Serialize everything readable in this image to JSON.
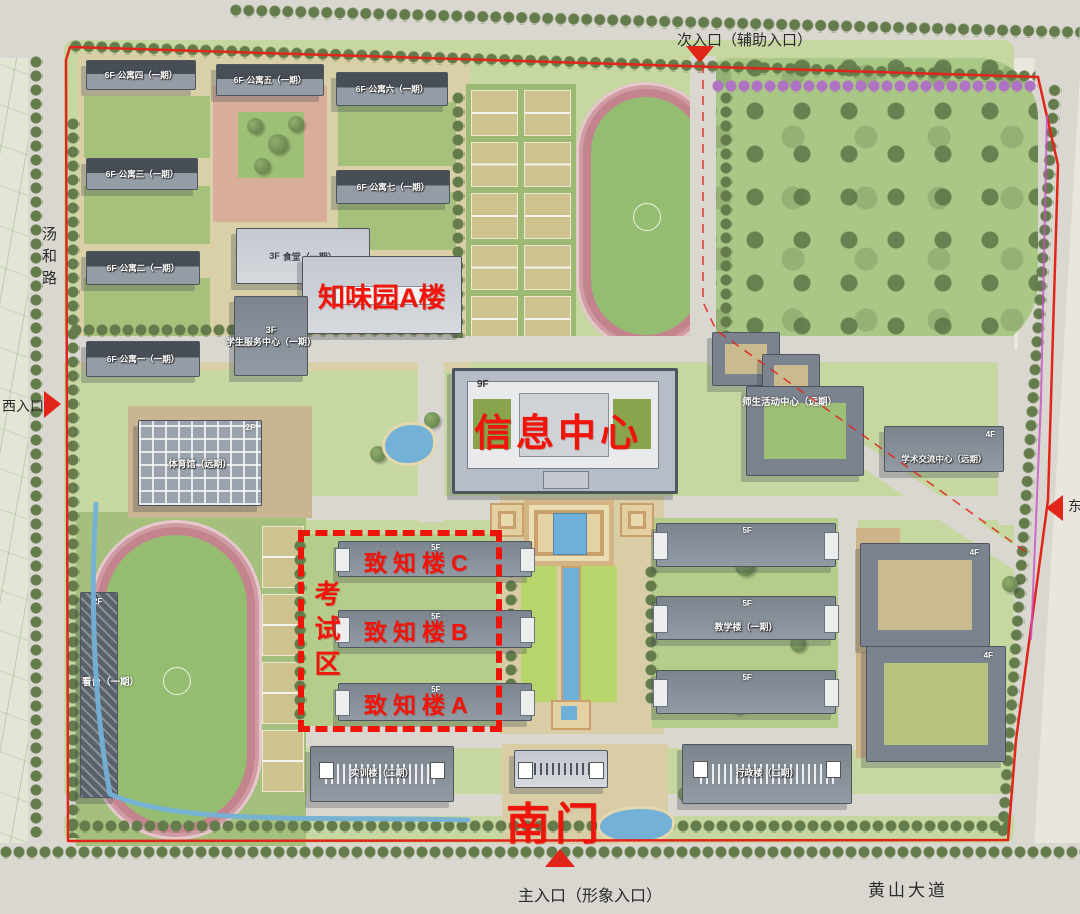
{
  "roads": {
    "west_road": "汤和路",
    "south_road": "黄山大道"
  },
  "entrances": {
    "north": "次入口（辅助入口）",
    "south": "主入口（形象入口）",
    "west": "西入口",
    "east": "东入口"
  },
  "red_annotations": {
    "canteen_area": "知味园A楼",
    "info_center": "信息中心",
    "exam_zone": "考试区",
    "zhizhi_c": "致知楼C",
    "zhizhi_b": "致知楼B",
    "zhizhi_a": "致知楼A",
    "south_gate": "南门"
  },
  "buildings": {
    "dorm_1": {
      "name": "公寓一（一期）",
      "floors": "6F"
    },
    "dorm_2": {
      "name": "公寓二（一期）",
      "floors": "6F"
    },
    "dorm_3": {
      "name": "公寓三（一期）",
      "floors": "6F"
    },
    "dorm_4": {
      "name": "公寓四（一期）",
      "floors": "6F"
    },
    "dorm_5": {
      "name": "公寓五（一期）",
      "floors": "6F"
    },
    "dorm_6": {
      "name": "公寓六（一期）",
      "floors": "6F"
    },
    "dorm_7": {
      "name": "公寓七（一期）",
      "floors": "6F"
    },
    "canteen": {
      "name": "食堂（一期）",
      "floors": "3F"
    },
    "student_service": {
      "name": "学生服务中心（一期）",
      "floors": "3F"
    },
    "gym": {
      "name": "体育馆（远期）",
      "floors": "2F"
    },
    "grandstand": {
      "name": "看台（一期）",
      "floors": "2F"
    },
    "info_center": {
      "floors": "9F"
    },
    "zhizhi": {
      "floors": "5F"
    },
    "teaching_east": {
      "name": "教学楼（一期）",
      "floors": "5F"
    },
    "activity_center": {
      "name": "师生活动中心（远期）"
    },
    "academic_center": {
      "name": "学术交流中心（远期）",
      "floors": "4F"
    },
    "startup_garden": {
      "name": "创业园地",
      "floors": "4F"
    },
    "lab": {
      "name": "实验楼（二期）",
      "floors": "4F"
    },
    "training": {
      "name": "实训楼（二期）"
    },
    "admin": {
      "name": "行政楼（二期）"
    }
  },
  "colors": {
    "label_red": "#f0140a",
    "boundary_red": "#e1251b",
    "water_blue": "#74b1d7"
  }
}
